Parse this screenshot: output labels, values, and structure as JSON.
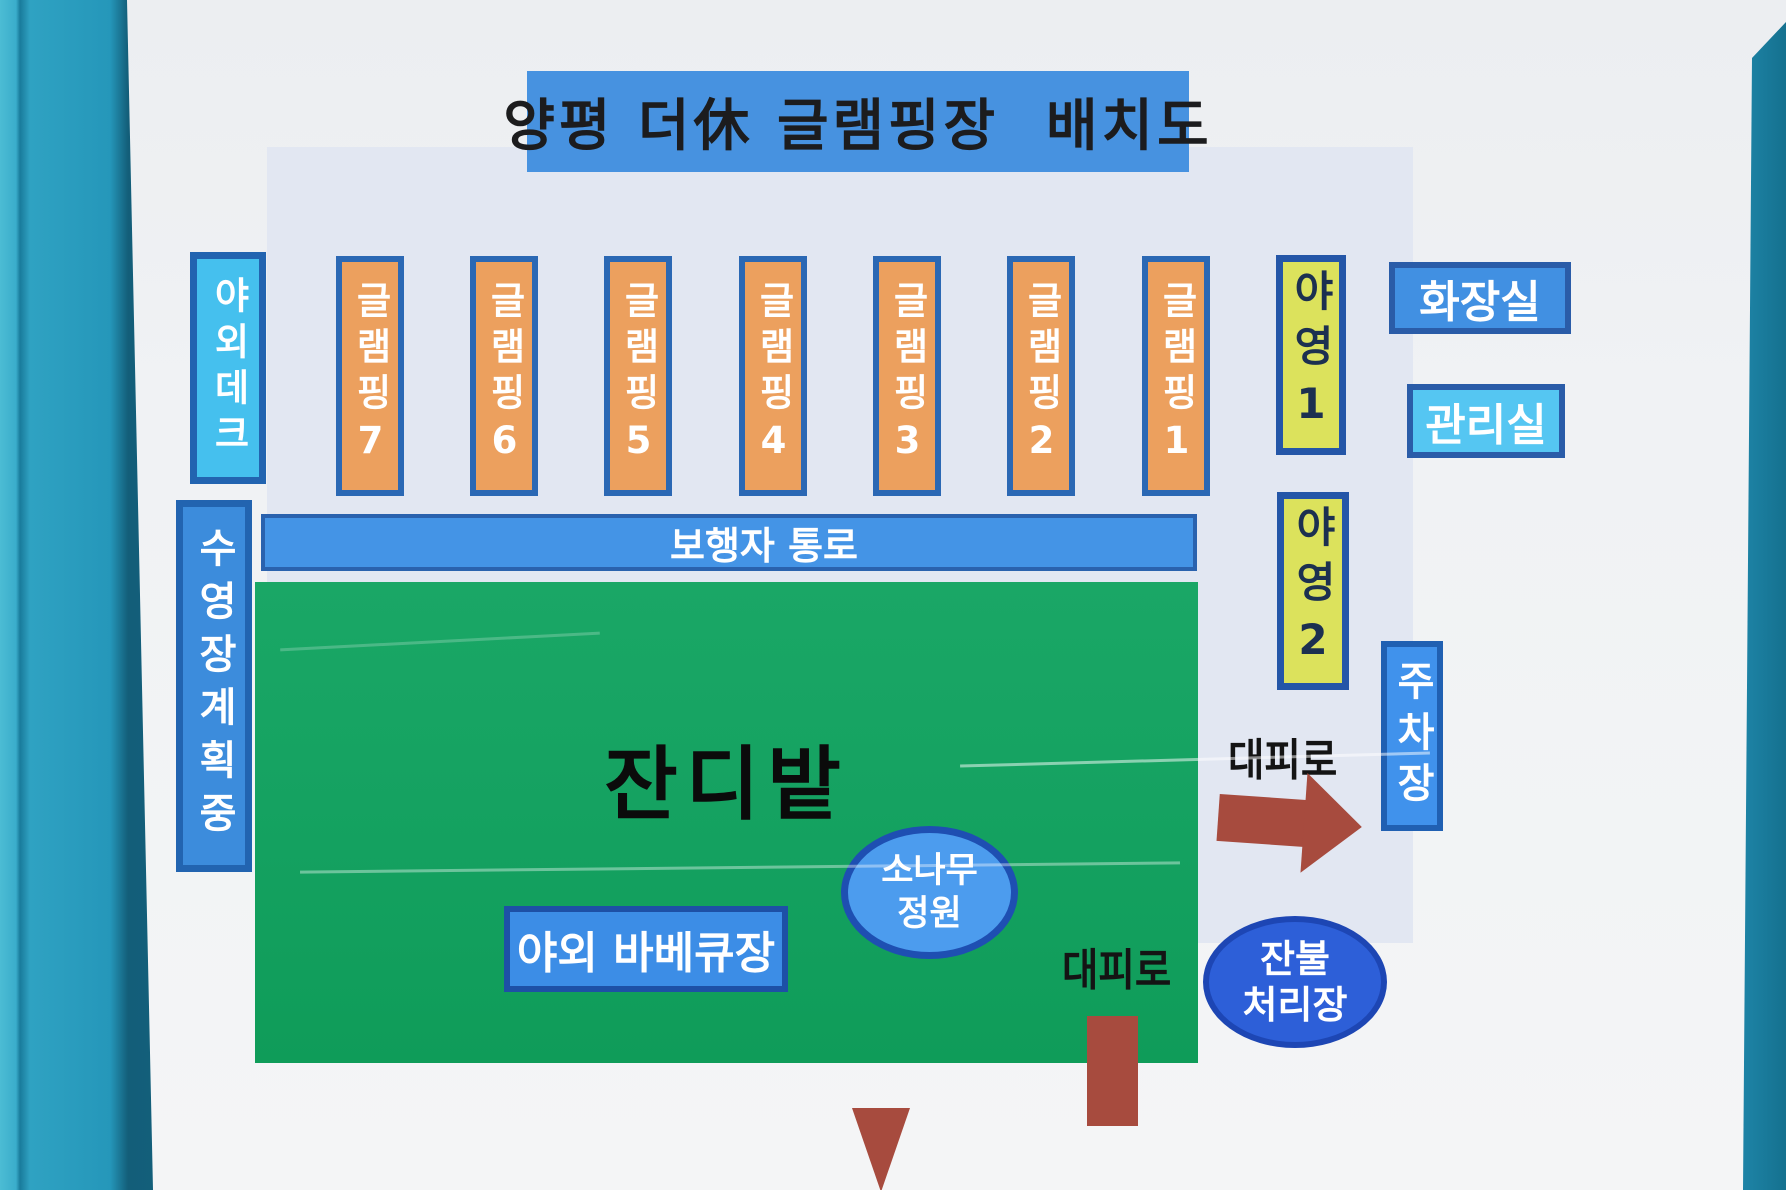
{
  "title": "양평 더休 글램핑장  배치도",
  "map": {
    "outdoor_deck": "야외데크",
    "pool_planned": "수영장계획중",
    "glamping": [
      "글램핑7",
      "글램핑6",
      "글램핑5",
      "글램핑4",
      "글램핑3",
      "글램핑2",
      "글램핑1"
    ],
    "camping1": "야영1",
    "camping2": "야영2",
    "restroom": "화장실",
    "office": "관리실",
    "walkway": "보행자 통로",
    "lawn": "잔디밭",
    "bbq": "야외 바베큐장",
    "pine_garden": {
      "line1": "소나무",
      "line2": "정원"
    },
    "parking": "주차장",
    "evac_route_right": "대피로",
    "evac_route_bottom": "대피로",
    "ember_disposal": {
      "line1": "잔불",
      "line2": "처리장"
    }
  },
  "colors": {
    "wall_teal": "#2597ba",
    "board_white": "#f0f2f4",
    "panel_light_blue": "#e2e7f2",
    "title_bar_blue": "#4792e0",
    "glamping_orange": "#eca05e",
    "camping_yellow": "#dce25c",
    "deck_cyan": "#45c0ee",
    "pool_blue": "#3c8cdc",
    "restroom_blue": "#4190e2",
    "office_cyan": "#55c6f2",
    "walkway_blue": "#4494e6",
    "lawn_green": "#14a160",
    "bbq_blue": "#3c8de6",
    "pine_blue": "#4c9cee",
    "ember_blue": "#2d5fd8",
    "parking_blue": "#4092ec",
    "evac_brown": "#a74b3e",
    "border_blue": "#2565b0"
  }
}
